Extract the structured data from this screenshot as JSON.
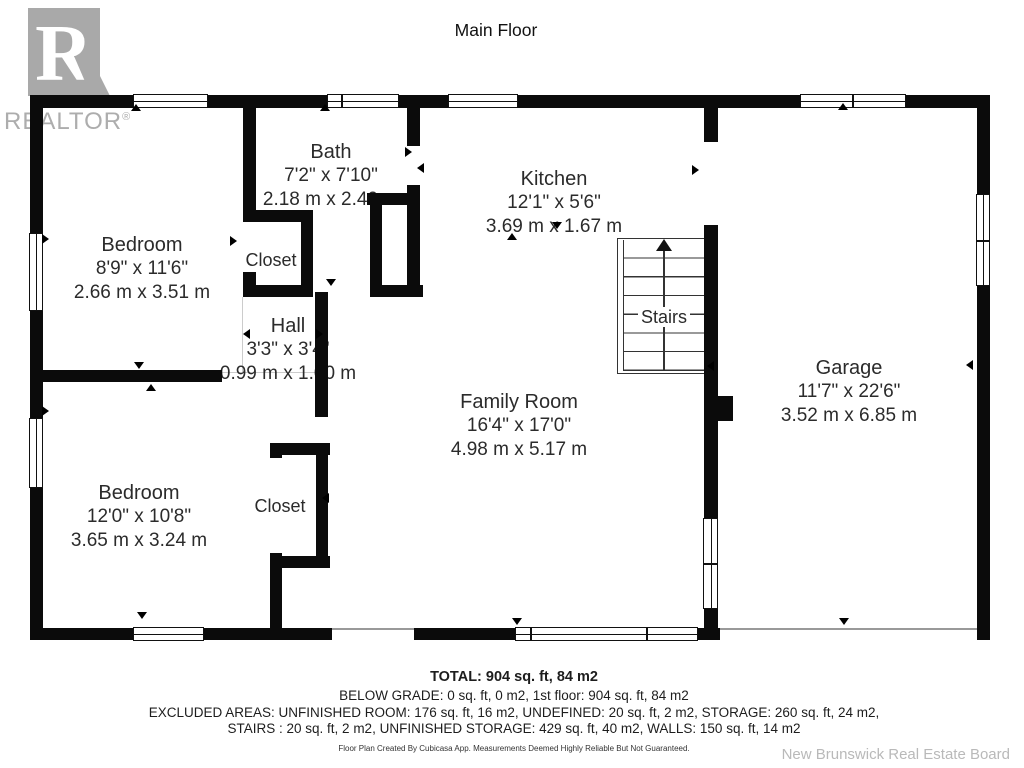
{
  "title": "Main Floor",
  "logo": {
    "brand": "REALTOR",
    "registered": "®"
  },
  "rooms": [
    {
      "name": "Bath",
      "dims_ft": "7'2\" x 7'10\"",
      "dims_m": "2.18 m x 2.40 m"
    },
    {
      "name": "Kitchen",
      "dims_ft": "12'1\" x 5'6\"",
      "dims_m": "3.69 m x 1.67 m"
    },
    {
      "name": "Bedroom",
      "dims_ft": "8'9\" x 11'6\"",
      "dims_m": "2.66 m x 3.51 m"
    },
    {
      "name": "Closet",
      "dims_ft": "",
      "dims_m": ""
    },
    {
      "name": "Hall",
      "dims_ft": "3'3\" x 3'4\"",
      "dims_m": "0.99 m x 1.00 m"
    },
    {
      "name": "Stairs",
      "dims_ft": "",
      "dims_m": ""
    },
    {
      "name": "Family Room",
      "dims_ft": "16'4\" x 17'0\"",
      "dims_m": "4.98 m x 5.17 m"
    },
    {
      "name": "Garage",
      "dims_ft": "11'7\" x 22'6\"",
      "dims_m": "3.52 m x 6.85 m"
    },
    {
      "name": "Bedroom",
      "dims_ft": "12'0\" x 10'8\"",
      "dims_m": "3.65 m x 3.24 m"
    },
    {
      "name": "Closet",
      "dims_ft": "",
      "dims_m": ""
    }
  ],
  "summary": {
    "total": "TOTAL: 904 sq. ft, 84 m2",
    "line2": "BELOW GRADE: 0 sq. ft, 0 m2, 1st floor: 904 sq. ft, 84 m2",
    "line3": "EXCLUDED AREAS: UNFINISHED ROOM: 176 sq. ft, 16 m2, UNDEFINED: 20 sq. ft, 2 m2, STORAGE: 260 sq. ft, 24 m2,",
    "line4": "STAIRS : 20 sq. ft, 2 m2, UNFINISHED STORAGE: 429 sq. ft, 40 m2, WALLS: 150 sq. ft, 14 m2",
    "disclaimer": "Floor Plan Created By Cubicasa App. Measurements Deemed Highly Reliable But Not Guaranteed."
  },
  "footer": {
    "attribution": "New Brunswick Real Estate Board"
  }
}
